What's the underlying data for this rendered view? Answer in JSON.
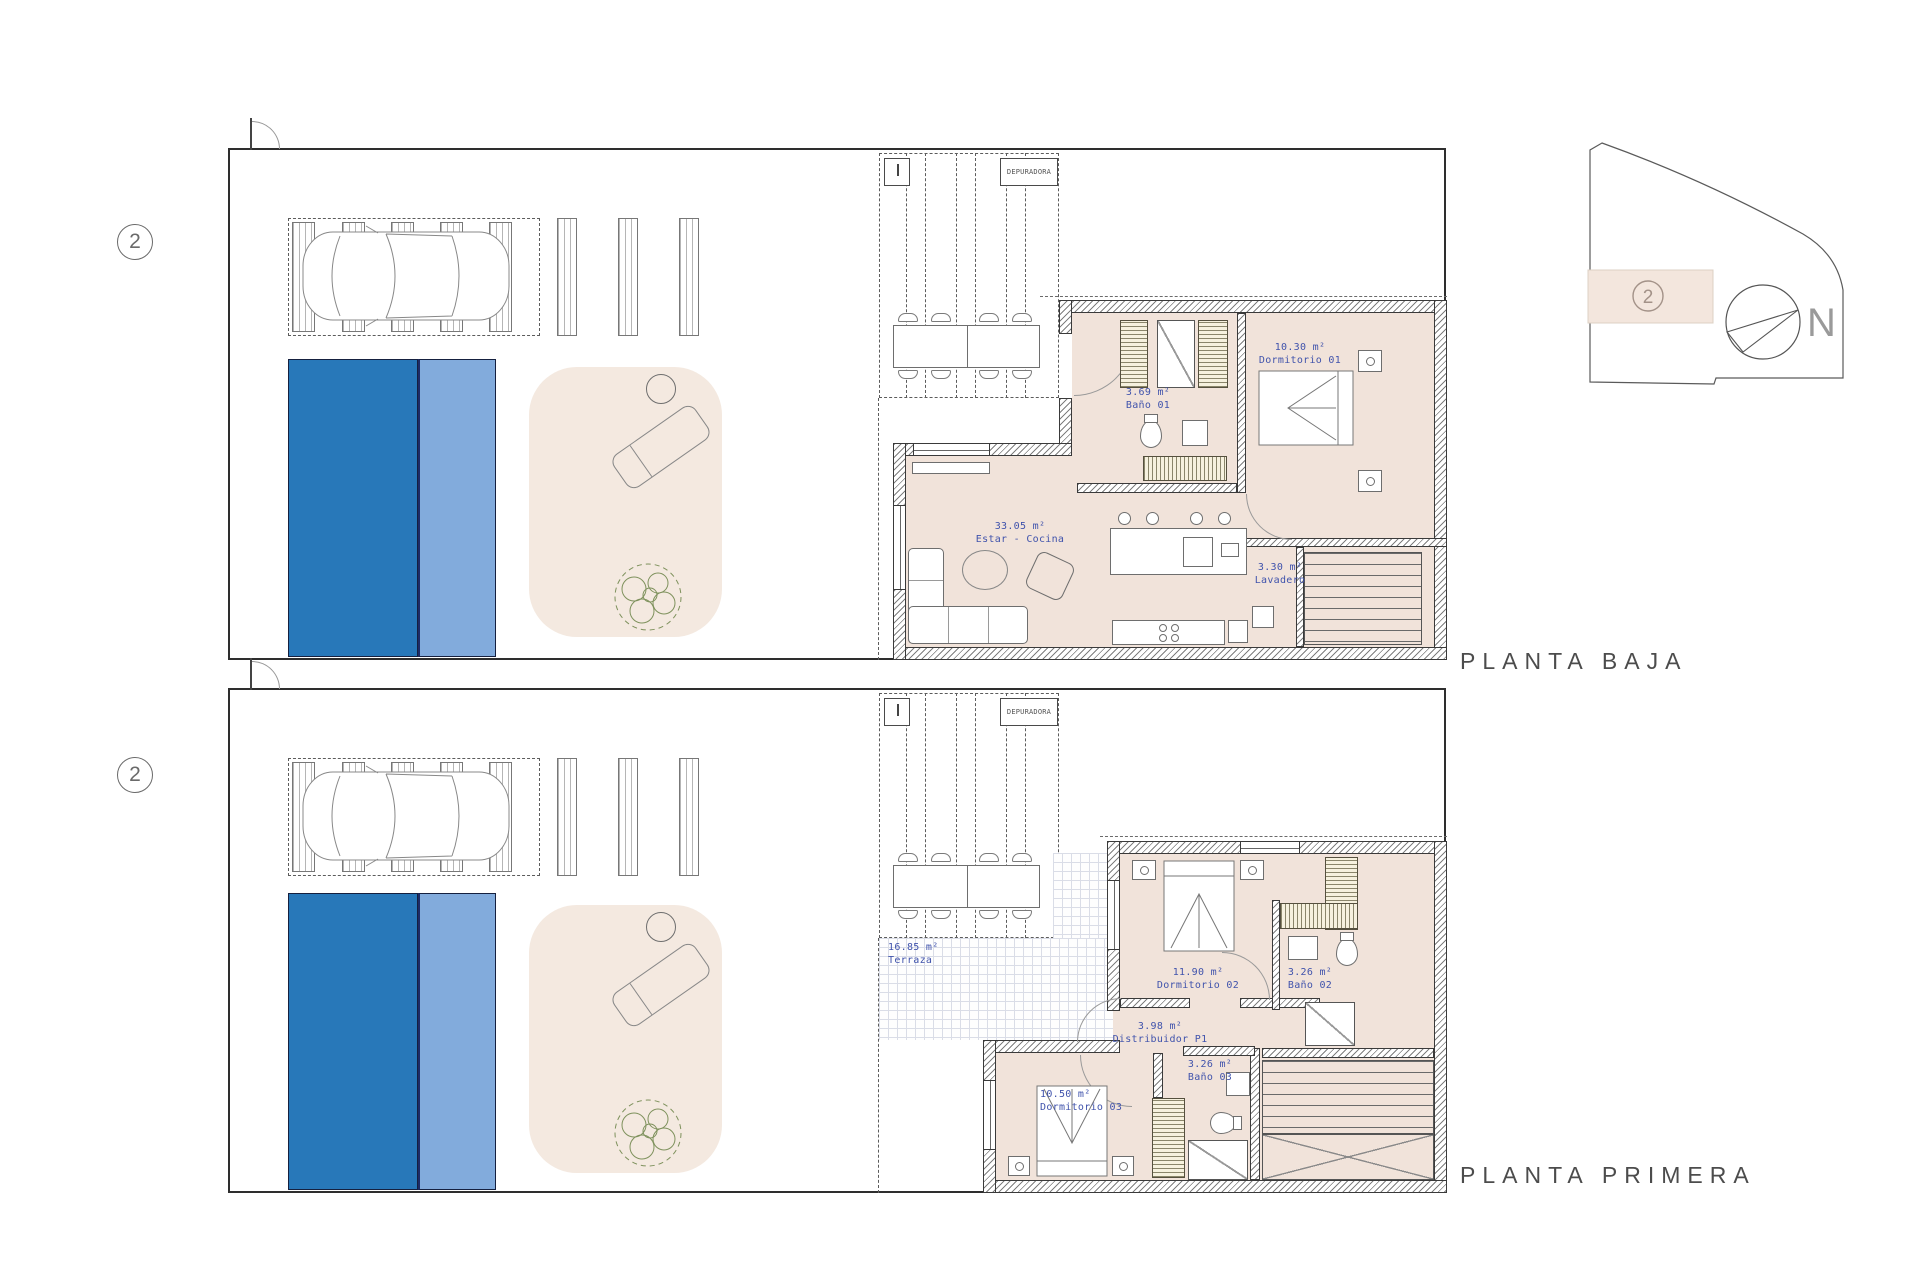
{
  "unit_badge": "2",
  "site_key": {
    "badge": "2",
    "north": "N"
  },
  "colors": {
    "pool_dark": "#2878B9",
    "pool_light": "#82ABDC",
    "room_fill": "#F1E3DA",
    "terrace_fill": "#F4E9E0",
    "label_blue": "#4053AC"
  },
  "plans": [
    {
      "title": "PLANTA BAJA",
      "badge": "2",
      "equipment": {
        "depuradora": "DEPURADORA"
      },
      "rooms": [
        {
          "area": "10.30 m²",
          "name": "Dormitorio 01"
        },
        {
          "area": "3.69 m²",
          "name": "Baño 01"
        },
        {
          "area": "33.05 m²",
          "name": "Estar - Cocina"
        },
        {
          "area": "3.30 m²",
          "name": "Lavadero"
        }
      ]
    },
    {
      "title": "PLANTA PRIMERA",
      "badge": "2",
      "equipment": {
        "depuradora": "DEPURADORA"
      },
      "rooms": [
        {
          "area": "16.85 m²",
          "name": "Terraza"
        },
        {
          "area": "11.90 m²",
          "name": "Dormitorio 02"
        },
        {
          "area": "3.26 m²",
          "name": "Baño 02"
        },
        {
          "area": "3.98 m²",
          "name": "Distribuidor P1"
        },
        {
          "area": "3.26 m²",
          "name": "Baño 03"
        },
        {
          "area": "10.50 m²",
          "name": "Dormitorio 03"
        }
      ]
    }
  ]
}
